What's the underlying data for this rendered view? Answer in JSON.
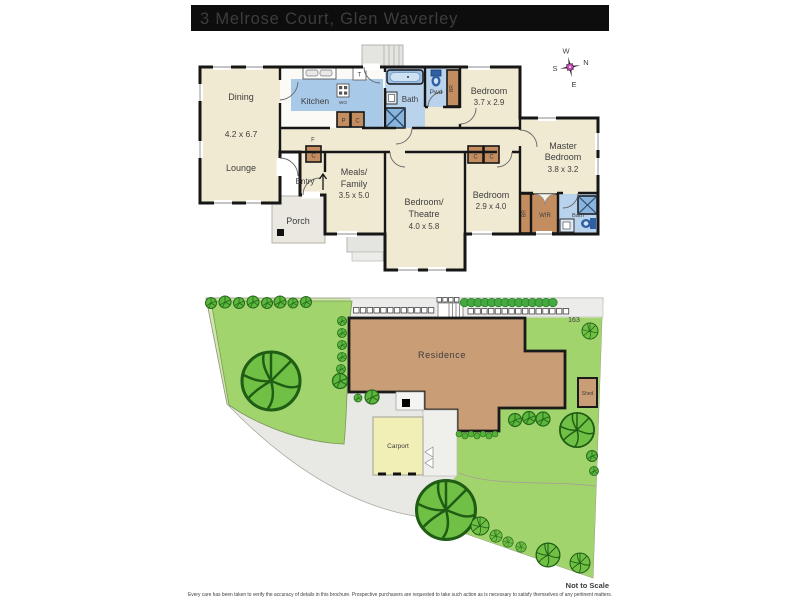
{
  "title": "3 Melrose Court, Glen Waverley",
  "compass": {
    "north": "N",
    "south": "S",
    "east": "E",
    "west": "W"
  },
  "floorplan": {
    "dining": {
      "name": "Dining",
      "dims": "4.2 x 6.7"
    },
    "lounge": {
      "name": "Lounge"
    },
    "kitchen": {
      "name": "Kitchen"
    },
    "bath": {
      "name": "Bath"
    },
    "powder": {
      "name": "Pwd"
    },
    "bedroom2": {
      "name": "Bedroom",
      "dims": "3.7 x 2.9"
    },
    "master": {
      "line1": "Master",
      "line2": "Bedroom",
      "dims": "3.8 x 3.2"
    },
    "meals": {
      "line1": "Meals/",
      "line2": "Family",
      "dims": "3.5 x 5.0"
    },
    "theatre": {
      "line1": "Bedroom/",
      "line2": "Theatre",
      "dims": "4.0 x 5.8"
    },
    "bedroom3": {
      "name": "Bedroom",
      "dims": "2.9 x 4.0"
    },
    "entry": {
      "name": "Entry"
    },
    "porch": {
      "name": "Porch"
    },
    "wir": {
      "name": "WIR"
    },
    "ensuite": {
      "name": "Bath"
    },
    "markers": {
      "pantry": "P",
      "cupboard": "C",
      "fridge": "F",
      "trough": "T",
      "wall_oven": "WO",
      "built_in_robe": "BR"
    }
  },
  "siteplan": {
    "residence": "Residence",
    "carport": "Carport",
    "shed": "Shed",
    "lot_number": "163"
  },
  "footer": {
    "scale_note": "Not to Scale",
    "disclaimer": "Every care has been taken to verify the accuracy of details in this brochure. Prospective purchasers are requested to take such action as is necessary to satisfy themselves of any pertinent matters."
  },
  "colors": {
    "title_bar": "#0d0d0d",
    "floor": "#f1ead3",
    "wet_area": "#b9d3ec",
    "kitchen_blue": "#a9c9e8",
    "cabinet": "#c48d60",
    "walls": "#161616",
    "property": "#cfe7ab",
    "lawn": "#a2d46e",
    "tree": "#6fc044",
    "residence": "#c99e76",
    "carport": "#f2efb6",
    "paving": "#e8e8e4",
    "compass_center": "#c34fb5"
  },
  "icons": {
    "compass-rose-icon": "8-point-star",
    "tree-icon": "circle-canopy",
    "bush-icon": "small-circle-canopy",
    "bathtub-icon": "rounded-rect-tub",
    "toilet-icon": "cistern-and-bowl",
    "shower-icon": "x-box",
    "vanity-icon": "square-basin",
    "sink-icon": "double-bowl",
    "cooktop-icon": "four-burner-grid",
    "entry-arrow-icon": "up-arrow"
  }
}
